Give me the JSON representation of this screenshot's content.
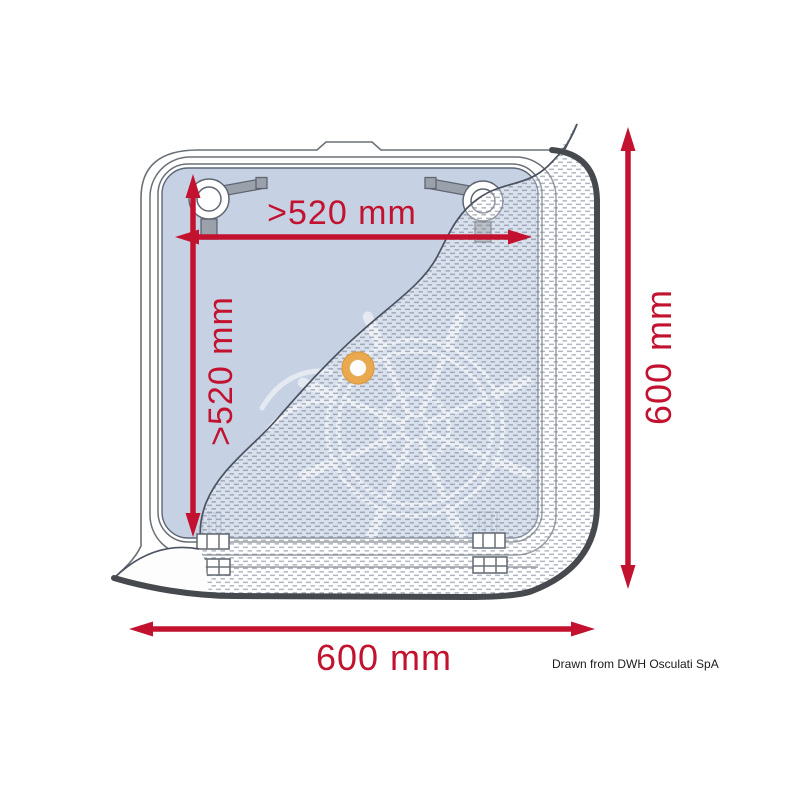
{
  "colors": {
    "dimension-red": "#c2122f",
    "glass-blue": "#c6d2e4",
    "line-gray": "#6a7076",
    "dark-edge": "#46494e",
    "grommet-orange": "#eaa94e",
    "attribution-black": "#1a1a1a",
    "page-bg": "#ffffff"
  },
  "diagram": {
    "dimensions": {
      "inner_width": ">520 mm",
      "inner_height": ">520 mm",
      "outer_height": "600 mm",
      "outer_width": "600 mm"
    },
    "attribution": "Drawn from DWH Osculati SpA",
    "icons": {
      "watermark": "ships-wheel-icon",
      "grommet": "grommet-ring-icon",
      "latch": "cam-latch-icon",
      "hinge": "hinge-icon"
    }
  }
}
